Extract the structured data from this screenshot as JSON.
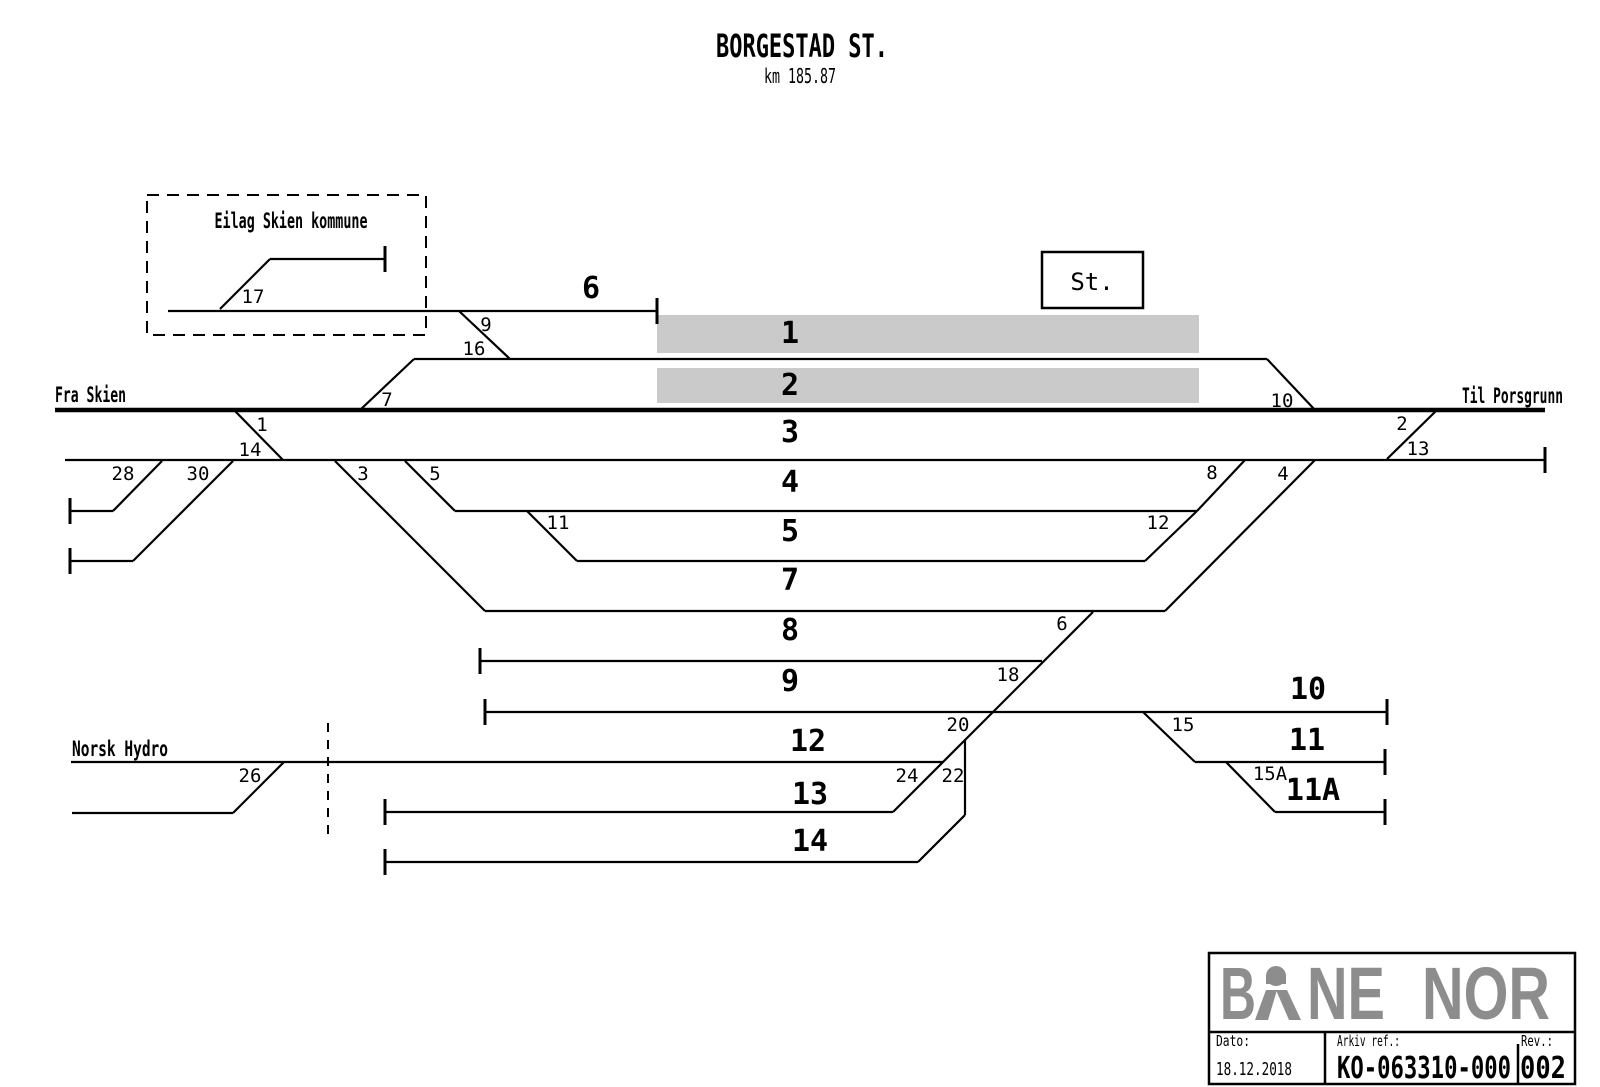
{
  "meta": {
    "station": "BORGESTAD ST.",
    "km": "km 185.87"
  },
  "colors": {
    "line": "#000000",
    "platform": "#cacaca",
    "logo_gray": "#8d8d8d",
    "background": "#ffffff"
  },
  "directions": {
    "from": "Fra Skien",
    "to": "Til Porsgrunn"
  },
  "areas": {
    "eilag": "Eilag Skien kommune",
    "norsk_hydro": "Norsk Hydro",
    "station_box": "St."
  },
  "tracks": [
    {
      "n": "1",
      "x": 790,
      "y": 343
    },
    {
      "n": "2",
      "x": 790,
      "y": 395
    },
    {
      "n": "3",
      "x": 790,
      "y": 442
    },
    {
      "n": "4",
      "x": 790,
      "y": 492
    },
    {
      "n": "5",
      "x": 790,
      "y": 541
    },
    {
      "n": "6",
      "x": 591,
      "y": 298
    },
    {
      "n": "7",
      "x": 790,
      "y": 590
    },
    {
      "n": "8",
      "x": 790,
      "y": 640
    },
    {
      "n": "9",
      "x": 790,
      "y": 691
    },
    {
      "n": "10",
      "x": 1308,
      "y": 699
    },
    {
      "n": "11",
      "x": 1307,
      "y": 750
    },
    {
      "n": "11A",
      "x": 1313,
      "y": 800
    },
    {
      "n": "12",
      "x": 808,
      "y": 751
    },
    {
      "n": "13",
      "x": 810,
      "y": 804
    },
    {
      "n": "14",
      "x": 810,
      "y": 851
    }
  ],
  "switches": [
    {
      "n": "17",
      "x": 253,
      "y": 303
    },
    {
      "n": "9",
      "x": 486,
      "y": 331
    },
    {
      "n": "16",
      "x": 474,
      "y": 355
    },
    {
      "n": "7",
      "x": 387,
      "y": 406
    },
    {
      "n": "1",
      "x": 262,
      "y": 431
    },
    {
      "n": "14",
      "x": 250,
      "y": 456
    },
    {
      "n": "28",
      "x": 123,
      "y": 480
    },
    {
      "n": "30",
      "x": 198,
      "y": 480
    },
    {
      "n": "3",
      "x": 363,
      "y": 480
    },
    {
      "n": "5",
      "x": 435,
      "y": 480
    },
    {
      "n": "11",
      "x": 558,
      "y": 529
    },
    {
      "n": "8",
      "x": 1212,
      "y": 479
    },
    {
      "n": "4",
      "x": 1283,
      "y": 480
    },
    {
      "n": "12",
      "x": 1158,
      "y": 529
    },
    {
      "n": "10",
      "x": 1282,
      "y": 407
    },
    {
      "n": "2",
      "x": 1402,
      "y": 430
    },
    {
      "n": "13",
      "x": 1418,
      "y": 455
    },
    {
      "n": "6",
      "x": 1062,
      "y": 630
    },
    {
      "n": "18",
      "x": 1008,
      "y": 681
    },
    {
      "n": "20",
      "x": 958,
      "y": 731
    },
    {
      "n": "24",
      "x": 907,
      "y": 782
    },
    {
      "n": "22",
      "x": 953,
      "y": 782
    },
    {
      "n": "26",
      "x": 250,
      "y": 782
    },
    {
      "n": "15",
      "x": 1183,
      "y": 731
    },
    {
      "n": "15A",
      "x": 1270,
      "y": 780
    }
  ],
  "segments": [
    {
      "name": "track-6-line",
      "x1": 168,
      "y1": 311,
      "x2": 657,
      "y2": 311
    },
    {
      "name": "eilag-spur-line",
      "x1": 270,
      "y1": 259,
      "x2": 385,
      "y2": 259
    },
    {
      "name": "switch-17-diagonal",
      "x1": 220,
      "y1": 309,
      "x2": 270,
      "y2": 259
    },
    {
      "name": "track-1-line",
      "x1": 414,
      "y1": 359,
      "x2": 1267,
      "y2": 359
    },
    {
      "name": "switch-7-diagonal",
      "x1": 360,
      "y1": 410,
      "x2": 414,
      "y2": 359
    },
    {
      "name": "switch-9-diagonal",
      "x1": 459,
      "y1": 311,
      "x2": 510,
      "y2": 359
    },
    {
      "name": "switch-10-diagonal",
      "x1": 1267,
      "y1": 359,
      "x2": 1315,
      "y2": 410
    },
    {
      "name": "main-line",
      "x1": 55,
      "y1": 410,
      "x2": 1545,
      "y2": 410,
      "w": 4.5
    },
    {
      "name": "track-3-line",
      "x1": 65,
      "y1": 460,
      "x2": 1545,
      "y2": 460
    },
    {
      "name": "switch-1-diagonal",
      "x1": 235,
      "y1": 411,
      "x2": 283,
      "y2": 460
    },
    {
      "name": "switch-2-diagonal",
      "x1": 1387,
      "y1": 459,
      "x2": 1437,
      "y2": 410
    },
    {
      "name": "stub-28-line",
      "x1": 70,
      "y1": 511,
      "x2": 113,
      "y2": 511
    },
    {
      "name": "switch-28-diagonal",
      "x1": 113,
      "y1": 511,
      "x2": 162,
      "y2": 461
    },
    {
      "name": "stub-30-line",
      "x1": 70,
      "y1": 561,
      "x2": 133,
      "y2": 561
    },
    {
      "name": "switch-30-diagonal",
      "x1": 133,
      "y1": 561,
      "x2": 233,
      "y2": 461
    },
    {
      "name": "track-4-line",
      "x1": 455,
      "y1": 511,
      "x2": 1197,
      "y2": 511
    },
    {
      "name": "switch-5-diagonal",
      "x1": 405,
      "y1": 461,
      "x2": 455,
      "y2": 511
    },
    {
      "name": "switch-8-diagonal",
      "x1": 1197,
      "y1": 511,
      "x2": 1245,
      "y2": 460
    },
    {
      "name": "track-5-line",
      "x1": 577,
      "y1": 561,
      "x2": 1145,
      "y2": 561
    },
    {
      "name": "switch-11-diagonal",
      "x1": 527,
      "y1": 511,
      "x2": 577,
      "y2": 561
    },
    {
      "name": "switch-12-diagonal",
      "x1": 1145,
      "y1": 561,
      "x2": 1197,
      "y2": 511
    },
    {
      "name": "track-7-line",
      "x1": 485,
      "y1": 611,
      "x2": 1165,
      "y2": 611
    },
    {
      "name": "switch-3-diagonal",
      "x1": 335,
      "y1": 461,
      "x2": 485,
      "y2": 611
    },
    {
      "name": "switch-4-diagonal",
      "x1": 1165,
      "y1": 611,
      "x2": 1315,
      "y2": 460
    },
    {
      "name": "track-8-line",
      "x1": 480,
      "y1": 661,
      "x2": 1042,
      "y2": 661
    },
    {
      "name": "track-9-line",
      "x1": 485,
      "y1": 712,
      "x2": 1387,
      "y2": 712
    },
    {
      "name": "yard-diagonal",
      "x1": 893,
      "y1": 812,
      "x2": 1093,
      "y2": 612
    },
    {
      "name": "track-12-line",
      "x1": 71,
      "y1": 762,
      "x2": 943,
      "y2": 762
    },
    {
      "name": "stub-26-line",
      "x1": 72,
      "y1": 813,
      "x2": 233,
      "y2": 813
    },
    {
      "name": "switch-26-diagonal",
      "x1": 233,
      "y1": 813,
      "x2": 284,
      "y2": 762
    },
    {
      "name": "track-13-line",
      "x1": 385,
      "y1": 812,
      "x2": 893,
      "y2": 812
    },
    {
      "name": "track-14-line",
      "x1": 385,
      "y1": 862,
      "x2": 918,
      "y2": 862
    },
    {
      "name": "switch-22-diagonal",
      "x1": 918,
      "y1": 862,
      "x2": 965,
      "y2": 815
    },
    {
      "name": "switch-22-vertical",
      "x1": 965,
      "y1": 815,
      "x2": 965,
      "y2": 740
    },
    {
      "name": "switch-15-diagonal",
      "x1": 1143,
      "y1": 712,
      "x2": 1195,
      "y2": 762
    },
    {
      "name": "track-11-line",
      "x1": 1195,
      "y1": 762,
      "x2": 1385,
      "y2": 762
    },
    {
      "name": "switch-15A-diagonal",
      "x1": 1226,
      "y1": 762,
      "x2": 1275,
      "y2": 812
    },
    {
      "name": "track-11A-line",
      "x1": 1275,
      "y1": 812,
      "x2": 1385,
      "y2": 812
    }
  ],
  "buffers": [
    {
      "name": "track-6-end",
      "x": 657,
      "y": 311
    },
    {
      "name": "eilag-spur-end",
      "x": 385,
      "y": 259
    },
    {
      "name": "track-3-end",
      "x": 1545,
      "y": 460
    },
    {
      "name": "stub-28-end",
      "x": 70,
      "y": 511
    },
    {
      "name": "stub-30-end",
      "x": 70,
      "y": 561
    },
    {
      "name": "track-8-end",
      "x": 480,
      "y": 661
    },
    {
      "name": "track-9-end",
      "x": 485,
      "y": 712
    },
    {
      "name": "track-13-end",
      "x": 385,
      "y": 812
    },
    {
      "name": "track-14-end",
      "x": 385,
      "y": 862
    },
    {
      "name": "track-10-end",
      "x": 1387,
      "y": 712
    },
    {
      "name": "track-11-end",
      "x": 1385,
      "y": 762
    },
    {
      "name": "track-11A-end",
      "x": 1385,
      "y": 812
    }
  ],
  "platforms": [
    {
      "name": "platform-track-1",
      "x": 657,
      "y": 315,
      "w": 542,
      "h": 38
    },
    {
      "name": "platform-track-2",
      "x": 657,
      "y": 368,
      "w": 542,
      "h": 35
    }
  ],
  "title_block": {
    "logo_b": "B",
    "logo_ne": "NE",
    "logo_nor": "NOR",
    "dato_label": "Dato:",
    "dato_value": "18.12.2018",
    "arkiv_label": "Arkiv ref.:",
    "arkiv_value": "KO-063310-000",
    "rev_label": "Rev.:",
    "rev_value": "002"
  }
}
